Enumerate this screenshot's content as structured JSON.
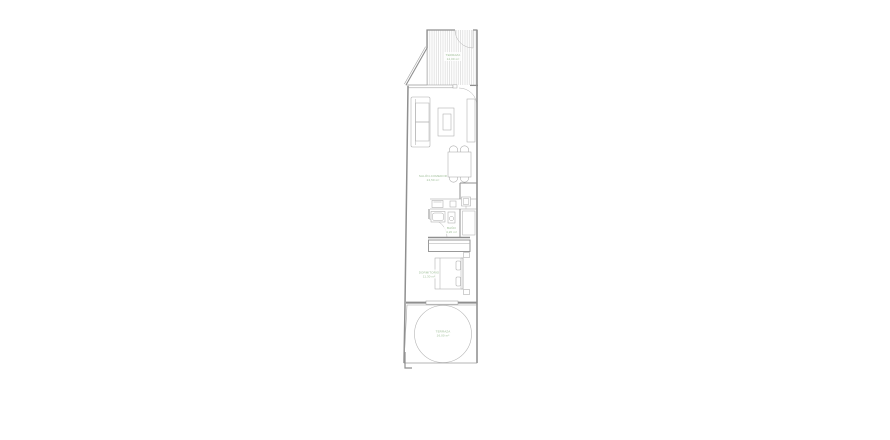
{
  "page": {
    "background": "#ffffff"
  },
  "floor_plan": {
    "description": "Narrow one-bedroom apartment floor plan",
    "label_color": "#9dbd96",
    "wall_color": "#8f8f8f",
    "furniture_color": "#ababab",
    "hatch_color": "#d9d9d9",
    "rooms": [
      {
        "id": "terrace-top",
        "name": "TERRAZA",
        "area": "12,00 m²"
      },
      {
        "id": "living-dining",
        "name": "SALÓN-COMEDOR",
        "area": "24,50 m²"
      },
      {
        "id": "bathroom",
        "name": "BAÑO",
        "area": "4,20 m²"
      },
      {
        "id": "bedroom",
        "name": "DORMITORIO",
        "area": "11,30 m²"
      },
      {
        "id": "terrace-bottom",
        "name": "TERRAZA",
        "area": "16,00 m²"
      }
    ]
  }
}
